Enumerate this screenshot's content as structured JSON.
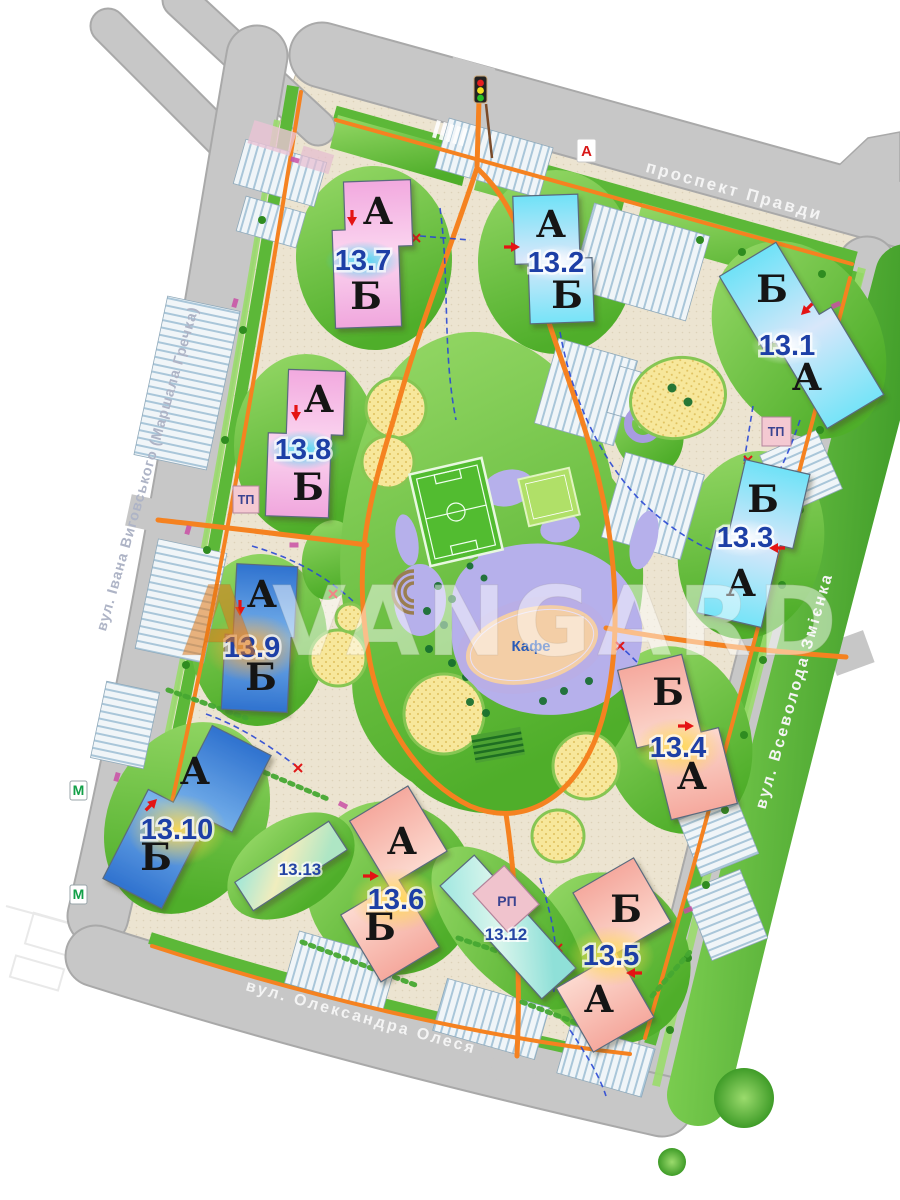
{
  "map": {
    "streets": {
      "top": "проспект Правди",
      "left": "вул. Івана Виговського (Маршала Гречка)",
      "right": "вул. Всеволода Змієнка",
      "bottom": "вул. Олександра Олеся"
    },
    "watermark": {
      "first": "A",
      "rest": "VANGARD"
    },
    "cafe": "Кафе",
    "markers": {
      "transit_stop": "А",
      "metro": "М",
      "transformer": "ТП",
      "distribution": "РП"
    },
    "buildings": [
      {
        "number": "13.7",
        "top_section": "А",
        "bottom_section": "Б"
      },
      {
        "number": "13.2",
        "top_section": "А",
        "bottom_section": "Б"
      },
      {
        "number": "13.1",
        "top_section": "Б",
        "bottom_section": "А"
      },
      {
        "number": "13.8",
        "top_section": "А",
        "bottom_section": "Б"
      },
      {
        "number": "13.3",
        "top_section": "Б",
        "bottom_section": "А"
      },
      {
        "number": "13.9",
        "top_section": "А",
        "bottom_section": "Б"
      },
      {
        "number": "13.10",
        "top_section": "А",
        "bottom_section": "Б"
      },
      {
        "number": "13.4",
        "top_section": "Б",
        "bottom_section": "А"
      },
      {
        "number": "13.6",
        "top_section": "А",
        "bottom_section": "Б"
      },
      {
        "number": "13.5",
        "top_section": "Б",
        "bottom_section": "А"
      },
      {
        "number": "13.13"
      },
      {
        "number": "13.12"
      }
    ]
  }
}
